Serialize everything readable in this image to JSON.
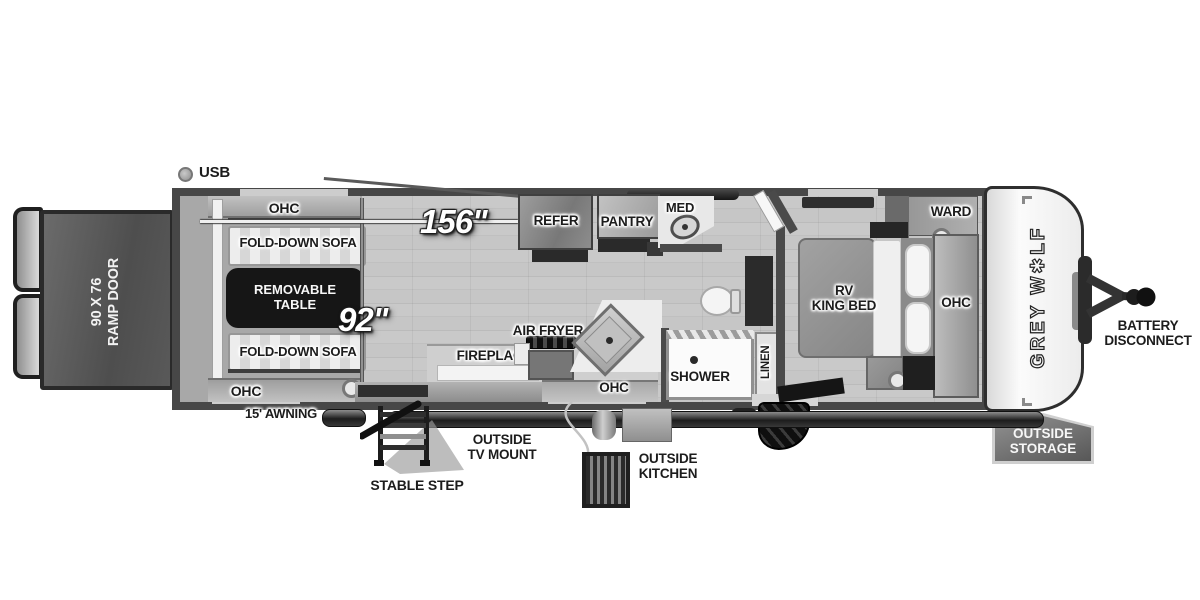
{
  "colors": {
    "wall": "#4a4a4a",
    "floor": "#c4c4c4",
    "garage_floor": "#a8a8a8",
    "table_fill": "#161616",
    "badge_fill": "#6e6e6e",
    "ramp_fill": "#575757",
    "text_dark": "#1c1c1c",
    "text_light": "#f7f7f7"
  },
  "exterior": {
    "usb_label": "USB",
    "ramp_door_label": "90 X 76\nRAMP DOOR",
    "awning_label": "15' AWNING",
    "stable_step_label": "STABLE STEP",
    "tv_mount_label": "OUTSIDE\nTV MOUNT",
    "outside_kitchen_label": "OUTSIDE\nKITCHEN",
    "outside_storage_label": "OUTSIDE\nSTORAGE",
    "battery_label": "BATTERY\nDISCONNECT"
  },
  "brand": {
    "prefix": "GREY W",
    "paw": "✱",
    "suffix": "LF"
  },
  "dims": {
    "length": "156\"",
    "width": "92\""
  },
  "garage": {
    "ohc_top": "OHC",
    "sofa_top": "FOLD-DOWN SOFA",
    "table": "REMOVABLE\nTABLE",
    "sofa_bottom": "FOLD-DOWN SOFA",
    "ohc_bottom": "OHC"
  },
  "kitchen": {
    "refer": "REFER",
    "pantry": "PANTRY",
    "med": "MED",
    "air_fryer": "AIR FRYER",
    "fireplace": "FIREPLACE",
    "ohc": "OHC"
  },
  "bath": {
    "shower": "SHOWER",
    "linen": "LINEN"
  },
  "bedroom": {
    "ward": "WARD",
    "bed": "RV\nKING BED",
    "ohc": "OHC"
  }
}
